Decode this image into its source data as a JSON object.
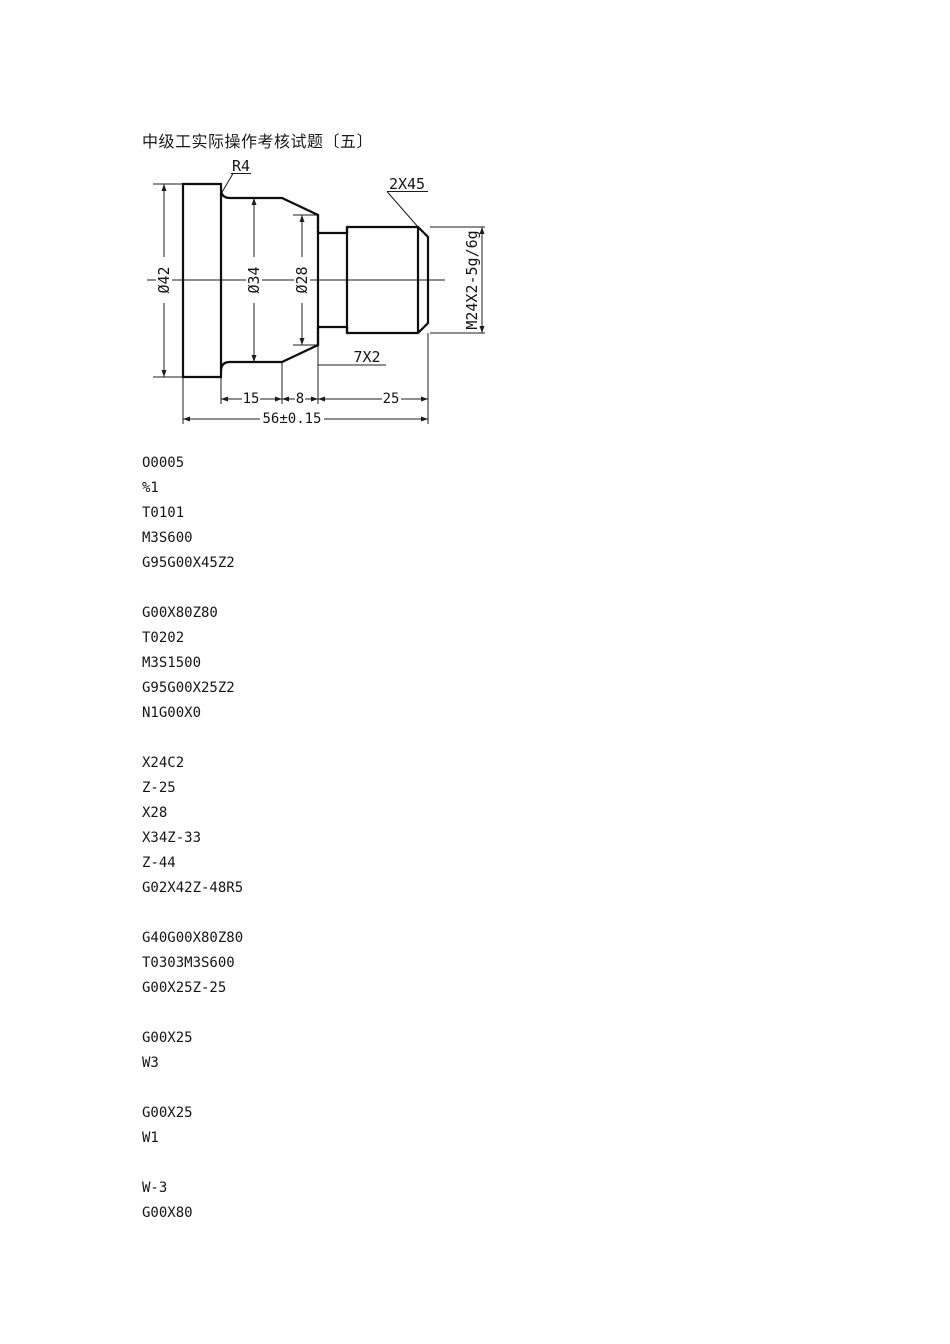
{
  "page": {
    "title": "中级工实际操作考核试题〔五〕"
  },
  "drawing": {
    "labels": {
      "fillet_radius": "R4",
      "chamfer": "2X45",
      "dia_42": "Ø42",
      "dia_34": "Ø34",
      "dia_28": "Ø28",
      "thread_spec": "M24X2-5g/6g",
      "groove": "7X2",
      "len_15": "15",
      "len_8": "8",
      "len_25": "25",
      "overall_length": "56±0.15"
    }
  },
  "gcode": {
    "blocks": [
      [
        "O0005",
        "%1",
        "T0101",
        "M3S600",
        "G95G00X45Z2"
      ],
      [
        "G00X80Z80",
        "T0202",
        "M3S1500",
        "G95G00X25Z2",
        "N1G00X0"
      ],
      [
        "X24C2",
        "Z-25",
        "X28",
        "X34Z-33",
        "Z-44",
        "G02X42Z-48R5"
      ],
      [
        "G40G00X80Z80",
        "T0303M3S600",
        "G00X25Z-25"
      ],
      [
        "G00X25",
        "W3"
      ],
      [
        "G00X25",
        "W1"
      ],
      [
        "W-3",
        "G00X80"
      ]
    ]
  }
}
